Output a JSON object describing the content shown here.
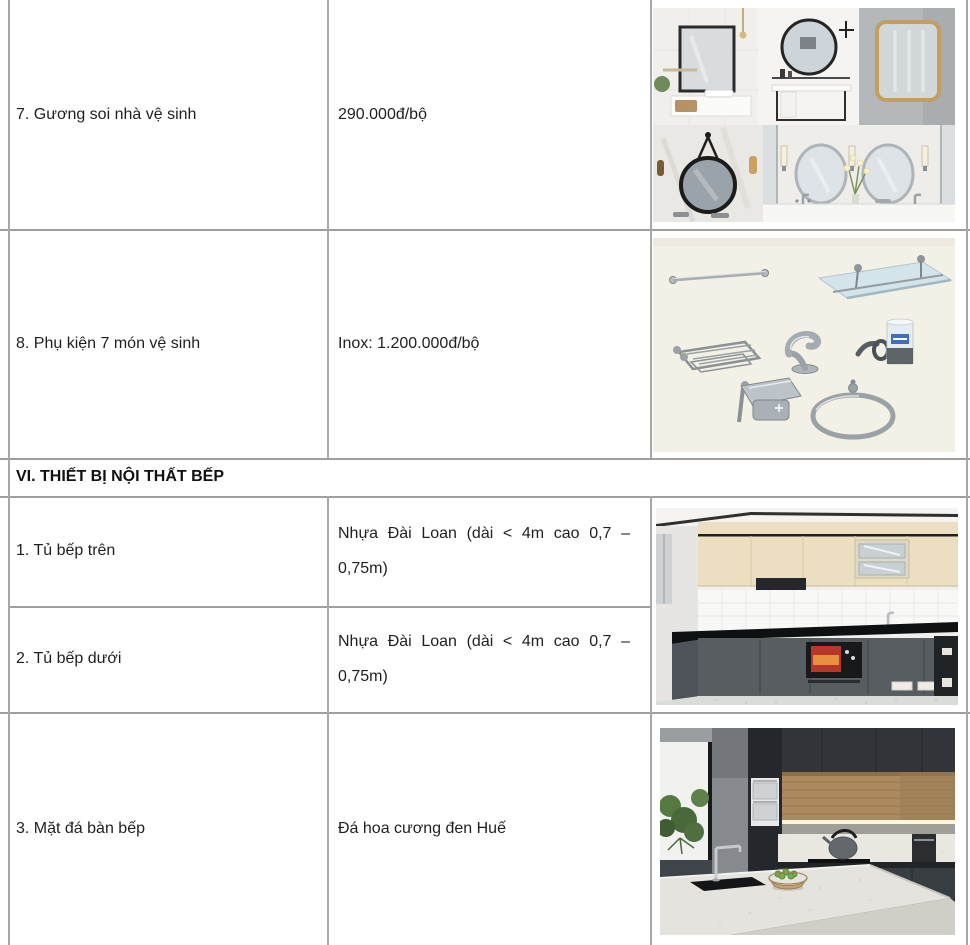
{
  "document": {
    "sanitary_rows": [
      {
        "label": "7. Gương soi nhà vệ sinh",
        "price": "290.000đ/bộ",
        "image": "bathroom-mirrors-collage"
      },
      {
        "label": "8. Phụ kiện 7 món vệ sinh",
        "price": "Inox: 1.200.000đ/bộ",
        "image": "stainless-7-piece-accessory-set"
      }
    ],
    "section_header": "VI. THIẾT BỊ NỘI THẤT BẾP",
    "kitchen_rows": [
      {
        "label": "1. Tủ bếp trên",
        "spec": "Nhựa Đài Loan (dài < 4m cao 0,7 – 0,75m)"
      },
      {
        "label": "2. Tủ bếp dưới",
        "spec": "Nhựa Đài Loan (dài < 4m cao 0,7 – 0,75m)"
      },
      {
        "label": "3. Mặt đá bàn bếp",
        "spec": "Đá hoa cương đen Huế"
      }
    ],
    "images": {
      "mirrors": "bathroom-mirrors-collage",
      "accessories": "stainless-7-piece-accessory-set",
      "cabinets": "kitchen-upper-lower-cabinets-photo",
      "countertop": "black-granite-countertop-kitchen-photo"
    },
    "colors": {
      "border": "#9e9e9e",
      "text": "#1f1f1f",
      "background": "#ffffff"
    }
  }
}
